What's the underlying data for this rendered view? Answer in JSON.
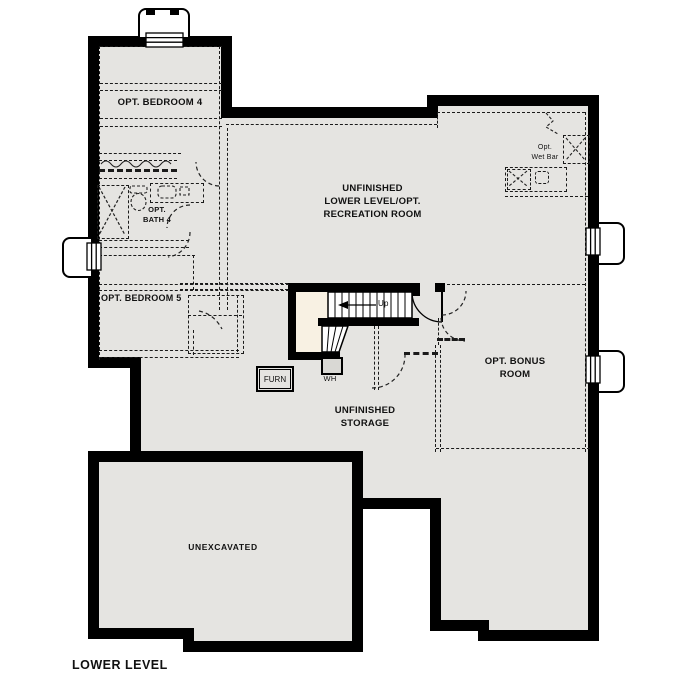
{
  "plan_title": "LOWER LEVEL",
  "rooms": {
    "bedroom4": {
      "label": "OPT. BEDROOM 4"
    },
    "bath4": {
      "l1": "OPT.",
      "l2": "BATH 4"
    },
    "bedroom5": {
      "label": "OPT. BEDROOM 5"
    },
    "rec": {
      "l1": "UNFINISHED",
      "l2": "LOWER LEVEL/OPT.",
      "l3": "RECREATION ROOM"
    },
    "wetbar": {
      "l1": "Opt.",
      "l2": "Wet Bar"
    },
    "bonus": {
      "l1": "OPT. BONUS",
      "l2": "ROOM"
    },
    "storage": {
      "l1": "UNFINISHED",
      "l2": "STORAGE"
    },
    "unexcavated": {
      "label": "UNEXCAVATED"
    }
  },
  "fixtures": {
    "furnace": "FURN",
    "water_heater": "WH",
    "stairs_direction": "Up"
  },
  "colors": {
    "floor": "#e5e4e1",
    "wall": "#000000",
    "stairfloor": "#f8f1e3",
    "dash": "#1a1a1a",
    "outside": "#ffffff"
  }
}
